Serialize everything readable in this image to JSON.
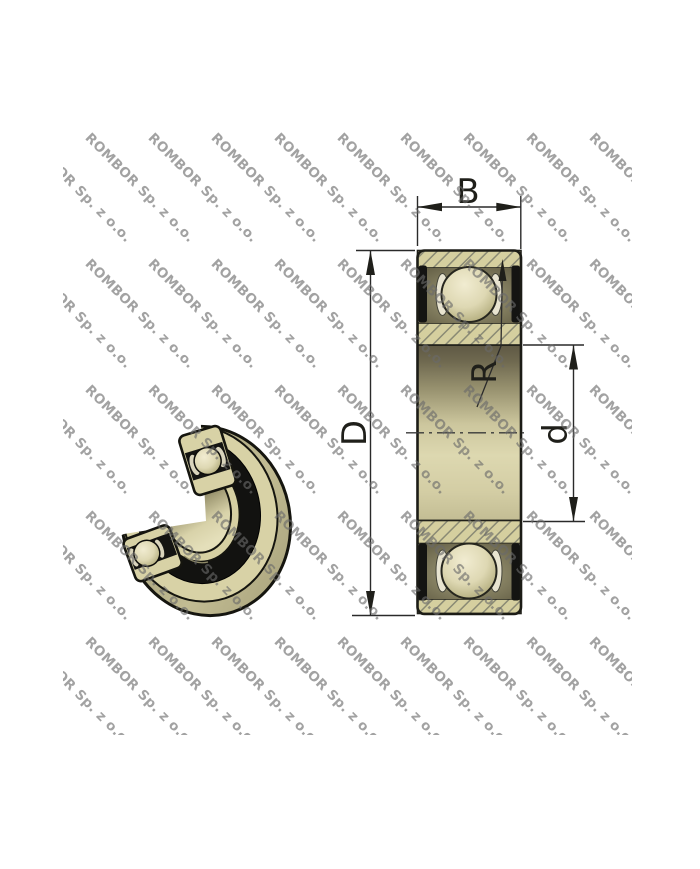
{
  "image": {
    "description": "Sealed deep groove ball bearing: 3D cutaway render (left) and dimensioned cross-section drawing (right)",
    "background": "#ffffff"
  },
  "watermark": {
    "text": "ROMBOR Sp. z o.o.",
    "color": "#6a6a6a"
  },
  "dimensions": {
    "width_label": "B",
    "outer_diameter_label": "D",
    "bore_diameter_label": "d",
    "corner_radius_label": "R"
  },
  "colors": {
    "ring_beige": "#d5cf9f",
    "hatch_line": "#8a8a74",
    "seal_black": "#141412",
    "ball_cream": "#e9e3c4",
    "outline": "#1c1c16",
    "dim_line": "#2a2a2a"
  }
}
